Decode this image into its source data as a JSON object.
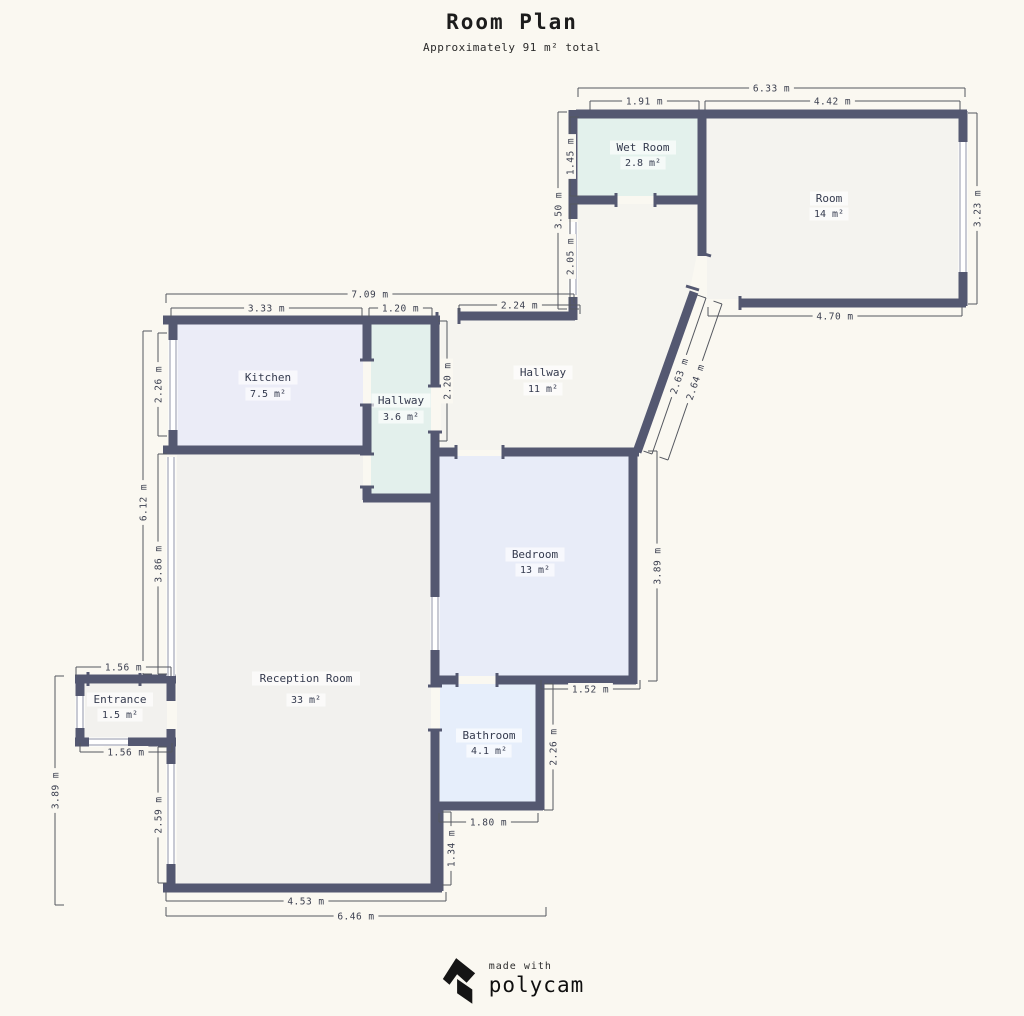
{
  "title": "Room Plan",
  "subtitle": "Approximately 91 m² total",
  "footer": {
    "made_with": "made with",
    "brand": "polycam"
  },
  "colors": {
    "bg": "#faf8f1",
    "wall": "#545871",
    "window_line": "#9095a8",
    "dim_line": "#54575f",
    "dim_text": "#3c4050",
    "room_text": "#343a4e",
    "highlight": "rgba(255,255,255,0.65)"
  },
  "plan": {
    "rooms": [
      {
        "id": "wet-room",
        "name": "Wet Room",
        "area": "2.8 m²",
        "fill": "#e3f1ec",
        "lx": 643,
        "name_y": 151,
        "area_y": 166,
        "pts": "578,118 698,118 698,196 578,196"
      },
      {
        "id": "room",
        "name": "Room",
        "area": "14 m²",
        "fill": "#f4f3ef",
        "lx": 829,
        "name_y": 202,
        "area_y": 217,
        "pts": "707,118 959,118 959,299 707,299"
      },
      {
        "id": "hallway-upper",
        "name": "Hallway",
        "area": "11 m²",
        "fill": "#f5f4ef",
        "lx": 543,
        "name_y": 376,
        "area_y": 392,
        "pts": "441,320 578,320 578,204 697,204 697,254 689,294 636,450 441,450"
      },
      {
        "id": "kitchen",
        "name": "Kitchen",
        "area": "7.5 m²",
        "fill": "#ebecf7",
        "lx": 268,
        "name_y": 381,
        "area_y": 397,
        "pts": "177,324 363,324 363,446 177,446"
      },
      {
        "id": "hallway-lower",
        "name": "Hallway",
        "area": "3.6 m²",
        "fill": "#e3f0ec",
        "lx": 401,
        "name_y": 404,
        "area_y": 420,
        "pts": "371,324 431,324 431,494 371,494"
      },
      {
        "id": "bedroom",
        "name": "Bedroom",
        "area": "13 m²",
        "fill": "#e8ecf8",
        "lx": 535,
        "name_y": 558,
        "area_y": 573,
        "pts": "439,456 629,456 629,676 439,676"
      },
      {
        "id": "reception-room",
        "name": "Reception Room",
        "area": "33 m²",
        "fill": "#f2f1ee",
        "lx": 306,
        "name_y": 682,
        "area_y": 703,
        "pts": "177,455 363,455 363,498 431,498 431,884 177,884"
      },
      {
        "id": "bathroom",
        "name": "Bathroom",
        "area": "4.1 m²",
        "fill": "#e6eefb",
        "lx": 489,
        "name_y": 739,
        "area_y": 754,
        "pts": "440,684 536,684 536,803 440,803"
      },
      {
        "id": "entrance",
        "name": "Entrance",
        "area": "1.5 m²",
        "fill": "#f2f1ee",
        "lx": 120,
        "name_y": 703,
        "area_y": 718,
        "pts": "85,684 167,684 167,739 85,739"
      }
    ],
    "walls": [
      [
        573,
        110,
        573,
        219
      ],
      [
        573,
        297,
        573,
        320
      ],
      [
        459,
        316,
        575,
        316
      ],
      [
        576,
        114,
        967,
        114
      ],
      [
        702,
        110,
        702,
        256
      ],
      [
        569,
        200,
        616,
        200
      ],
      [
        655,
        200,
        706,
        200
      ],
      [
        963,
        111,
        963,
        306
      ],
      [
        740,
        303,
        966,
        303
      ],
      [
        694,
        292,
        637,
        452
      ],
      [
        163,
        320,
        440,
        320
      ],
      [
        173,
        316,
        173,
        454
      ],
      [
        163,
        450,
        371,
        450
      ],
      [
        367,
        321,
        367,
        360
      ],
      [
        367,
        405,
        367,
        454
      ],
      [
        367,
        487,
        367,
        500
      ],
      [
        363,
        498,
        438,
        498
      ],
      [
        435,
        317,
        435,
        386
      ],
      [
        435,
        432,
        435,
        686
      ],
      [
        435,
        730,
        435,
        891
      ],
      [
        438,
        452,
        456,
        452
      ],
      [
        503,
        452,
        639,
        452
      ],
      [
        633,
        448,
        633,
        684
      ],
      [
        432,
        680,
        457,
        680
      ],
      [
        497,
        680,
        636,
        680
      ],
      [
        540,
        676,
        540,
        810
      ],
      [
        432,
        806,
        543,
        806
      ],
      [
        439,
        803,
        439,
        891
      ],
      [
        163,
        888,
        442,
        888
      ],
      [
        171,
        672,
        171,
        701
      ],
      [
        171,
        729,
        171,
        891
      ],
      [
        75,
        679,
        176,
        679
      ],
      [
        80,
        675,
        80,
        746
      ],
      [
        75,
        742,
        176,
        742
      ]
    ],
    "windows": [
      [
        173,
        340,
        173,
        430
      ],
      [
        573,
        222,
        573,
        295
      ],
      [
        963,
        142,
        963,
        272
      ],
      [
        171,
        457,
        171,
        676
      ],
      [
        435,
        597,
        435,
        650
      ],
      [
        171,
        764,
        171,
        864
      ],
      [
        80,
        696,
        80,
        728
      ],
      [
        89,
        742,
        128,
        742
      ]
    ],
    "door_ticks": [
      [
        616,
        193,
        616,
        207
      ],
      [
        655,
        193,
        655,
        207
      ],
      [
        740,
        296,
        740,
        310
      ],
      [
        437,
        312,
        437,
        328
      ],
      [
        459,
        308,
        459,
        324
      ],
      [
        360,
        360,
        374,
        360
      ],
      [
        360,
        405,
        374,
        405
      ],
      [
        360,
        454,
        374,
        454
      ],
      [
        360,
        487,
        374,
        487
      ],
      [
        428,
        386,
        442,
        386
      ],
      [
        428,
        432,
        442,
        432
      ],
      [
        456,
        445,
        456,
        459
      ],
      [
        503,
        445,
        503,
        459
      ],
      [
        457,
        673,
        457,
        687
      ],
      [
        497,
        673,
        497,
        687
      ],
      [
        428,
        686,
        442,
        686
      ],
      [
        428,
        730,
        442,
        730
      ],
      [
        88,
        672,
        88,
        686
      ],
      [
        140,
        672,
        140,
        686
      ],
      [
        698,
        252,
        711,
        256
      ],
      [
        686,
        286,
        699,
        290
      ]
    ],
    "dimensions": [
      {
        "label": "6.33 m",
        "x1": 578,
        "y1": 88,
        "x2": 965,
        "y2": 88,
        "side": 1,
        "rot": 0
      },
      {
        "label": "1.91 m",
        "x1": 590,
        "y1": 101,
        "x2": 699,
        "y2": 101,
        "side": 1,
        "rot": 0
      },
      {
        "label": "4.42 m",
        "x1": 705,
        "y1": 101,
        "x2": 960,
        "y2": 101,
        "side": 1,
        "rot": 0
      },
      {
        "label": "3.50 m",
        "x1": 558,
        "y1": 112,
        "x2": 558,
        "y2": 309,
        "side": -1,
        "rot": -90
      },
      {
        "label": "1.45 m",
        "x1": 570,
        "y1": 117,
        "x2": 570,
        "y2": 196,
        "side": -1,
        "rot": -90
      },
      {
        "label": "2.05 m",
        "x1": 570,
        "y1": 204,
        "x2": 570,
        "y2": 309,
        "side": -1,
        "rot": -90
      },
      {
        "label": "3.23 m",
        "x1": 977,
        "y1": 113,
        "x2": 977,
        "y2": 304,
        "side": 1,
        "rot": -90
      },
      {
        "label": "4.70 m",
        "x1": 708,
        "y1": 316,
        "x2": 962,
        "y2": 316,
        "side": -1,
        "rot": 0
      },
      {
        "label": "7.09 m",
        "x1": 166,
        "y1": 294,
        "x2": 574,
        "y2": 294,
        "side": 1,
        "rot": 0
      },
      {
        "label": "3.33 m",
        "x1": 171,
        "y1": 308,
        "x2": 362,
        "y2": 308,
        "side": 1,
        "rot": 0
      },
      {
        "label": "1.20 m",
        "x1": 369,
        "y1": 308,
        "x2": 432,
        "y2": 308,
        "side": 1,
        "rot": 0
      },
      {
        "label": "2.24 m",
        "x1": 459,
        "y1": 305,
        "x2": 580,
        "y2": 305,
        "side": 1,
        "rot": 0
      },
      {
        "label": "2.20 m",
        "x1": 447,
        "y1": 321,
        "x2": 447,
        "y2": 441,
        "side": 1,
        "rot": -90
      },
      {
        "label": "2.63 m",
        "x1": 706,
        "y1": 298,
        "x2": 652,
        "y2": 454,
        "side": 1,
        "rot": -71
      },
      {
        "label": "2.64 m",
        "x1": 722,
        "y1": 304,
        "x2": 668,
        "y2": 460,
        "side": 1,
        "rot": -71
      },
      {
        "label": "2.26 m",
        "x1": 158,
        "y1": 333,
        "x2": 158,
        "y2": 436,
        "side": -1,
        "rot": -90
      },
      {
        "label": "6.12 m",
        "x1": 143,
        "y1": 331,
        "x2": 143,
        "y2": 674,
        "side": -1,
        "rot": -90
      },
      {
        "label": "3.86 m",
        "x1": 158,
        "y1": 454,
        "x2": 158,
        "y2": 674,
        "side": -1,
        "rot": -90
      },
      {
        "label": "1.56 m",
        "x1": 76,
        "y1": 667,
        "x2": 171,
        "y2": 667,
        "side": 1,
        "rot": 0
      },
      {
        "label": "1.56 m",
        "x1": 80,
        "y1": 752,
        "x2": 172,
        "y2": 752,
        "side": -1,
        "rot": 0
      },
      {
        "label": "3.89 m",
        "x1": 55,
        "y1": 676,
        "x2": 55,
        "y2": 905,
        "side": -1,
        "rot": -90
      },
      {
        "label": "2.59 m",
        "x1": 158,
        "y1": 747,
        "x2": 158,
        "y2": 883,
        "side": -1,
        "rot": -90
      },
      {
        "label": "4.53 m",
        "x1": 166,
        "y1": 901,
        "x2": 446,
        "y2": 901,
        "side": -1,
        "rot": 0
      },
      {
        "label": "6.46 m",
        "x1": 166,
        "y1": 916,
        "x2": 546,
        "y2": 916,
        "side": -1,
        "rot": 0
      },
      {
        "label": "1.52 m",
        "x1": 541,
        "y1": 689,
        "x2": 640,
        "y2": 689,
        "side": -1,
        "rot": 0
      },
      {
        "label": "3.89 m",
        "x1": 657,
        "y1": 451,
        "x2": 657,
        "y2": 681,
        "side": 1,
        "rot": -90
      },
      {
        "label": "2.26 m",
        "x1": 553,
        "y1": 684,
        "x2": 553,
        "y2": 810,
        "side": 1,
        "rot": -90
      },
      {
        "label": "1.80 m",
        "x1": 439,
        "y1": 822,
        "x2": 538,
        "y2": 822,
        "side": -1,
        "rot": 0
      },
      {
        "label": "1.34 m",
        "x1": 451,
        "y1": 812,
        "x2": 451,
        "y2": 885,
        "side": 1,
        "rot": -90
      }
    ]
  }
}
